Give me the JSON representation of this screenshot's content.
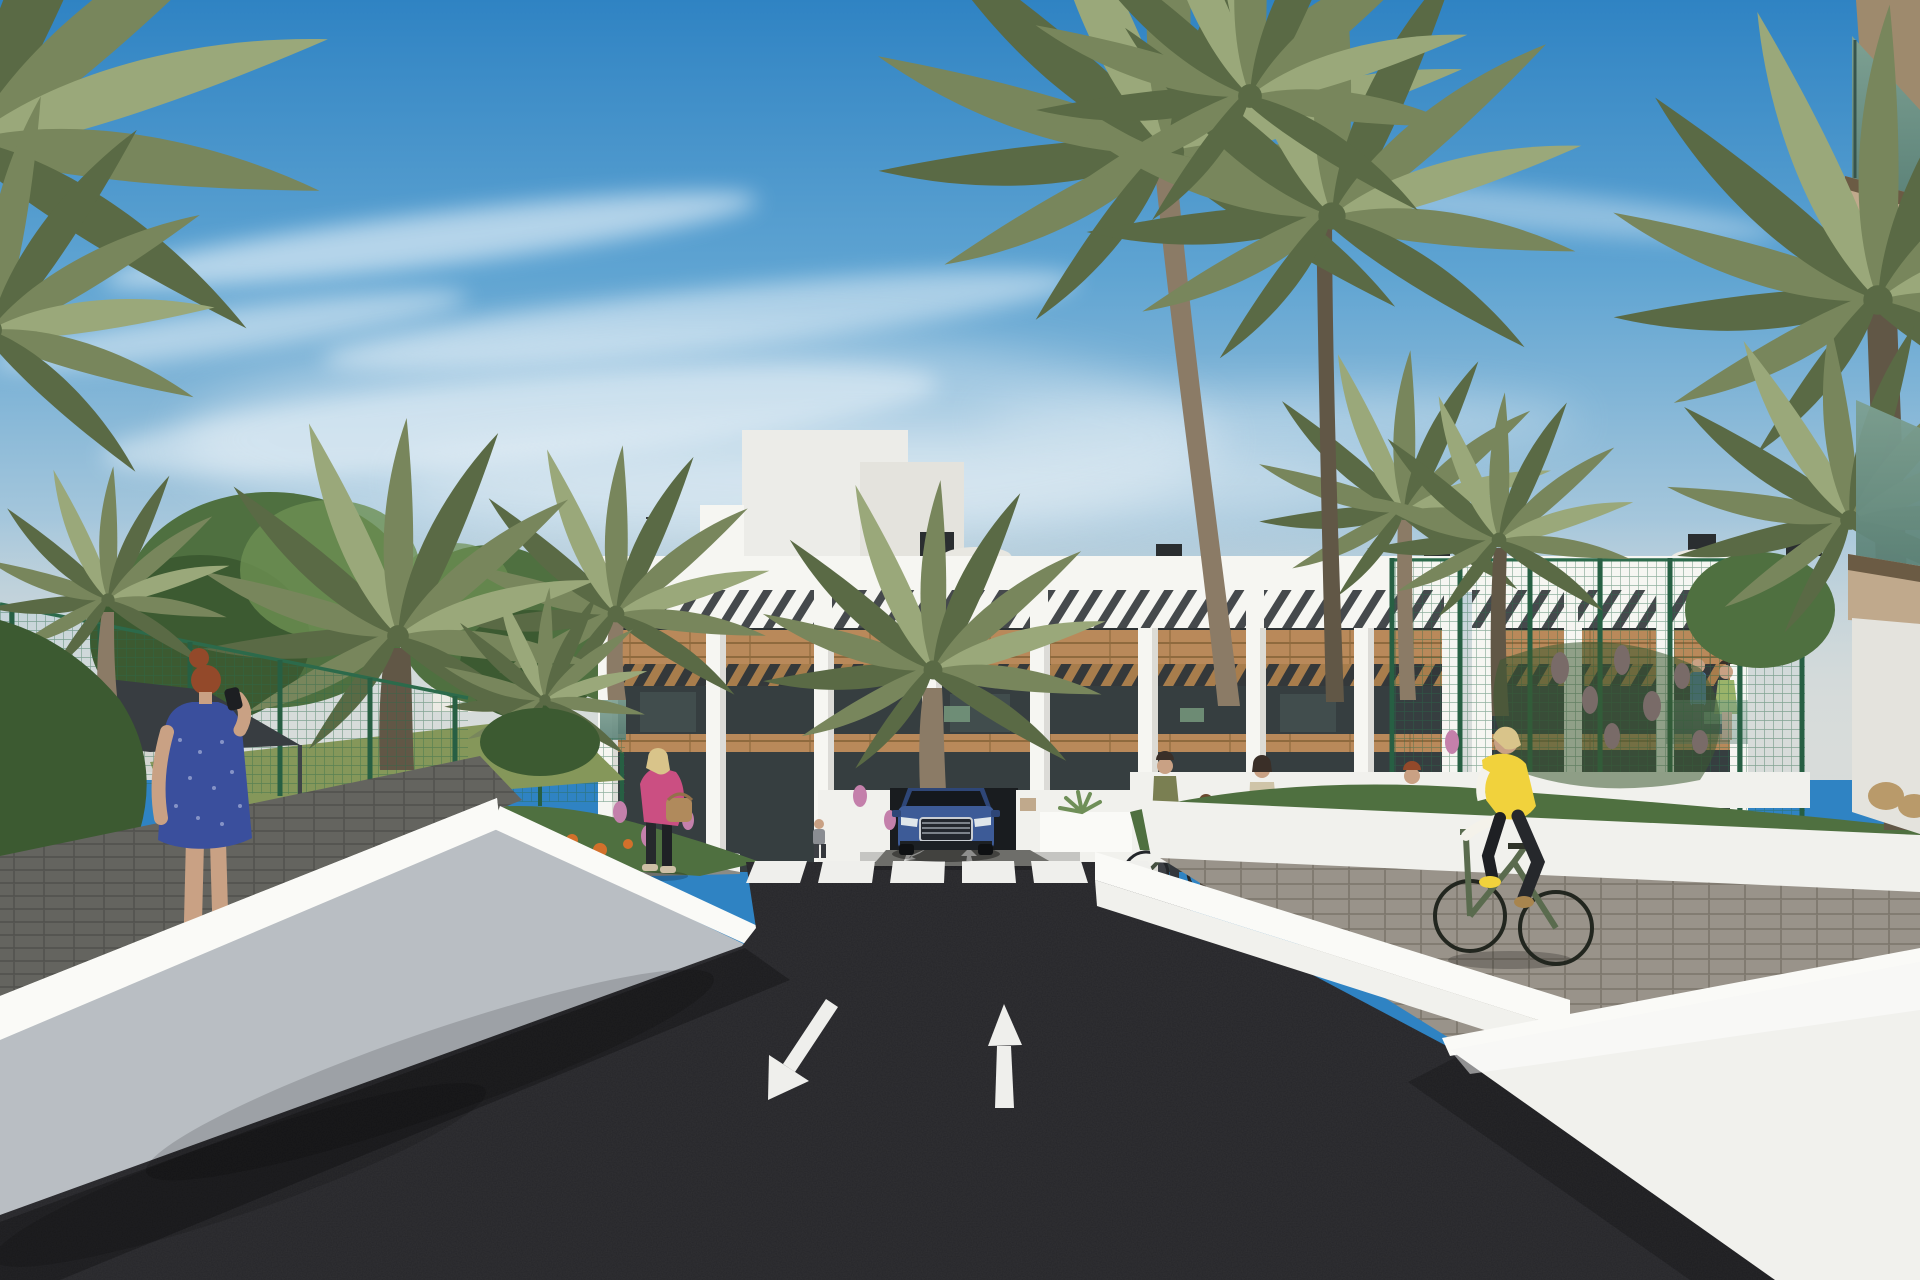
{
  "meta": {
    "title": "Residential complex street rendering",
    "type": "3D architectural visualization, photorealistic style",
    "canvas": "1920x1280"
  },
  "scene": {
    "setting": "Modern white Mediterranean apartment complex with wood accents, palm trees, landscaped courtyards and a private asphalt street leading to an underground garage ramp",
    "sky": "Blue sky with wispy cirrus clouds, pale haze at horizon",
    "vehicles": [
      "dark blue SUV emerging from underground garage ramp at street end"
    ],
    "road_markings": {
      "crosswalk_stripes": 6,
      "small_arrows_at_ramp": [
        "down-left",
        "up"
      ],
      "large_lane_arrows": [
        "down-left toward viewer",
        "up away from viewer"
      ]
    },
    "people": [
      "red-haired woman in blue patterned dress taking phone photo on left walkway",
      "man in light shirt walking away on left courtyard path",
      "blonde woman in magenta jacket with tan handbag walking right",
      "small pedestrian near building entrance",
      "woman wheeling bicycle at bike racks",
      "mother with child standing near bike racks",
      "second woman with bicycle further right",
      "couple standing on first-floor terrace of right wing",
      "blonde woman in yellow vest riding green bicycle on right paver path"
    ],
    "elements": [
      "three-story white apartment building with rooftop pergola slats",
      "stair bulkhead and chimneys and patio umbrellas on roof",
      "wood plank facade bands and wooden terrace pergolas",
      "dark glazed terraces and windows",
      "green chain-link fences both sides",
      "dark anthracite shade sail upper left",
      "date palms, fan palms and deciduous trees",
      "orange and pink flower beds",
      "white retaining walls with bright sunlit caps",
      "dark asphalt street with white markings",
      "black U-shaped bike racks",
      "foreground building edge with green glass balconies at right"
    ]
  },
  "palette": {
    "skyTop": "#2f83c3",
    "skyMid": "#5fa4d2",
    "skyLow": "#a8c8dc",
    "haze": "#d8dcda",
    "cloud": "#ffffff",
    "white": "#f6f6f2",
    "whiteShade": "#e4e3dd",
    "pierShade": "#d6d5cf",
    "windowDark": "#2e3335",
    "terraceDark": "#363e40",
    "slatDark": "#45494c",
    "wood": "#b9895a",
    "woodDark": "#8f6a3e",
    "woodSlat": "#a87d4c",
    "glass": "#5d8379",
    "glassLight": "#7da092",
    "tan": "#c0a98c",
    "tanDark": "#9e8a6d",
    "road": "#26262a",
    "lineWhite": "#efefec",
    "wallLit": "#fafaf7",
    "wallWhite": "#f1f1ed",
    "wallGray": "#b9bec3",
    "paver": "#99938a",
    "paverLine": "#7b756b",
    "walkDark": "#64645f",
    "walkLine": "#50504c",
    "fenceGreen": "#2c6a4b",
    "fencePost": "#27604306",
    "treeDark": "#3c5a31",
    "treeMid": "#4f7040",
    "treeLight": "#6d9052",
    "palmGreen": "#78865c",
    "palmDark": "#5a6a45",
    "palmLight": "#9aa87a",
    "trunk": "#8b7b66",
    "trunkDark": "#615746",
    "grass": "#85975a",
    "flowerOrange": "#d2702b",
    "flowerPink": "#c480ab",
    "sail": "#383d41",
    "carBlue": "#3d5b97",
    "carBlueDark": "#2e4677",
    "carDark": "#15181f",
    "chrome": "#c9cdd2",
    "skin": "#c9a184",
    "hairRed": "#93492a",
    "hairBlonde": "#d9c48a",
    "hairDark": "#3a2f28",
    "dressBlue": "#3a4f9d",
    "pinkJacket": "#cb4f82",
    "vestYellow": "#f1d23c",
    "bikeGreen": "#5a6b4e",
    "beige": "#d9cfb8",
    "jeans": "#7e8894",
    "olive": "#7a7f52"
  }
}
